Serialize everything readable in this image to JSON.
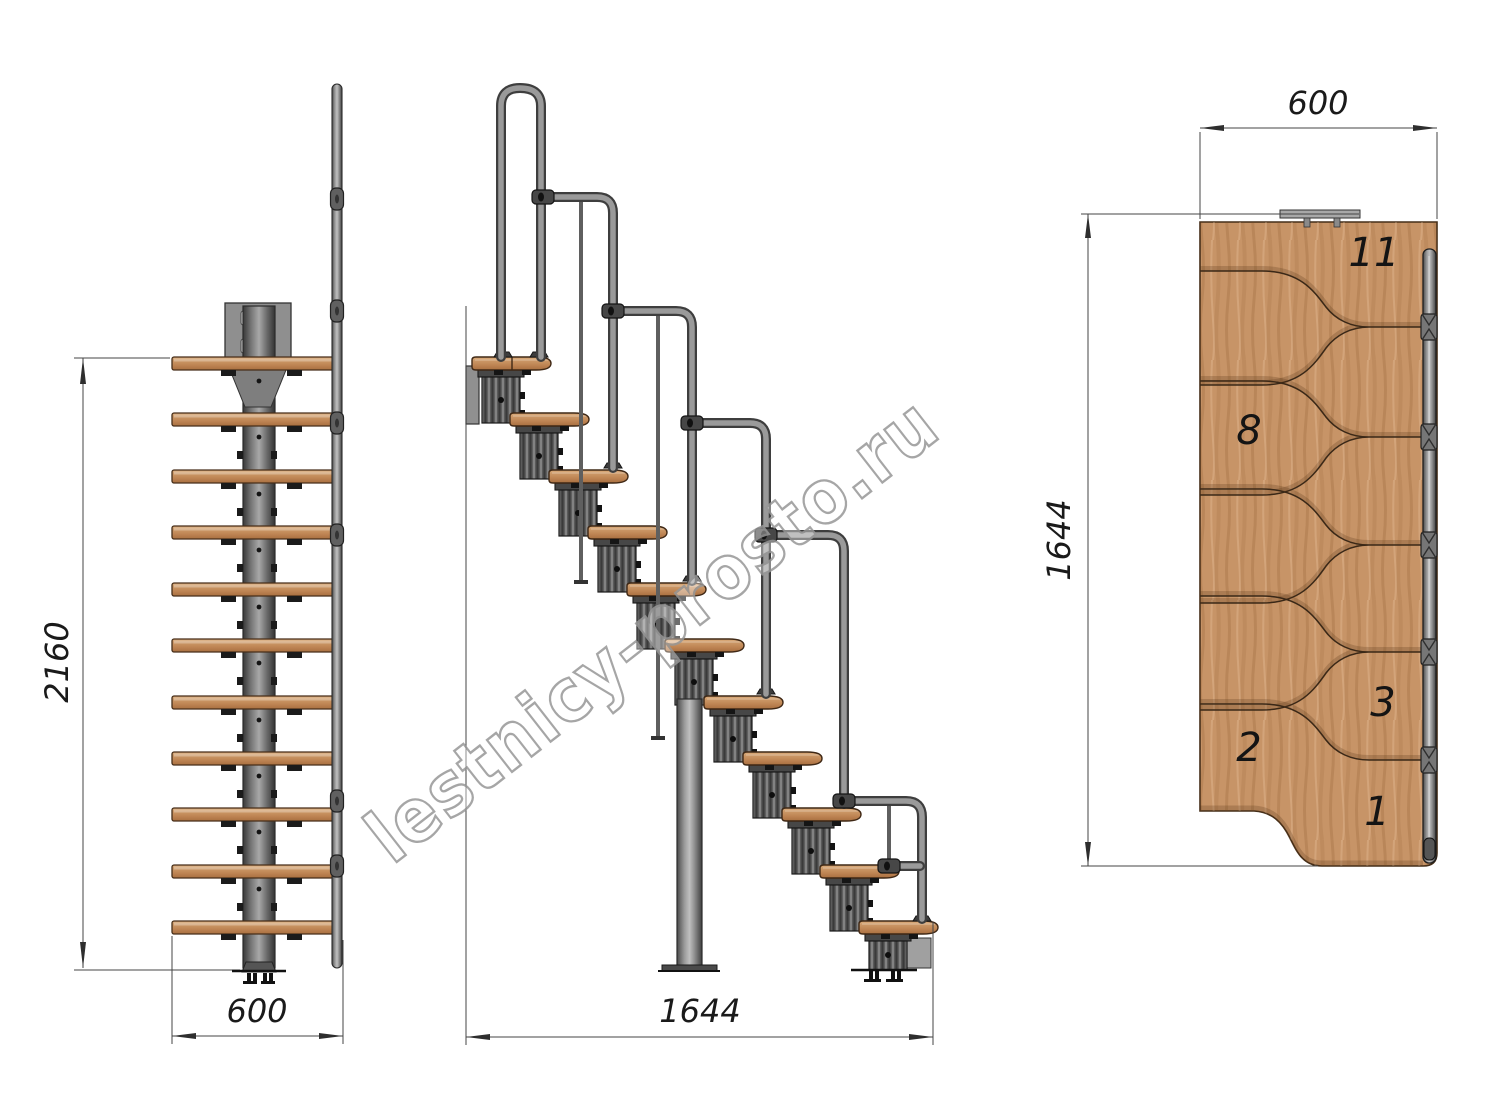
{
  "drawing": {
    "watermark": "lestnicy-prosto.ru",
    "front_view": {
      "height_dim": "2160",
      "width_dim": "600"
    },
    "side_view": {
      "length_dim": "1644"
    },
    "plan_view": {
      "width_dim": "600",
      "length_dim": "1644",
      "step_labels": [
        "11",
        "8",
        "3",
        "2",
        "1"
      ]
    },
    "colors": {
      "wood": "#c79467",
      "wood_dark": "#a9713f",
      "metal": "#8a8a8a",
      "module": "#5a5a5a",
      "line": "#3a3a3a"
    }
  }
}
